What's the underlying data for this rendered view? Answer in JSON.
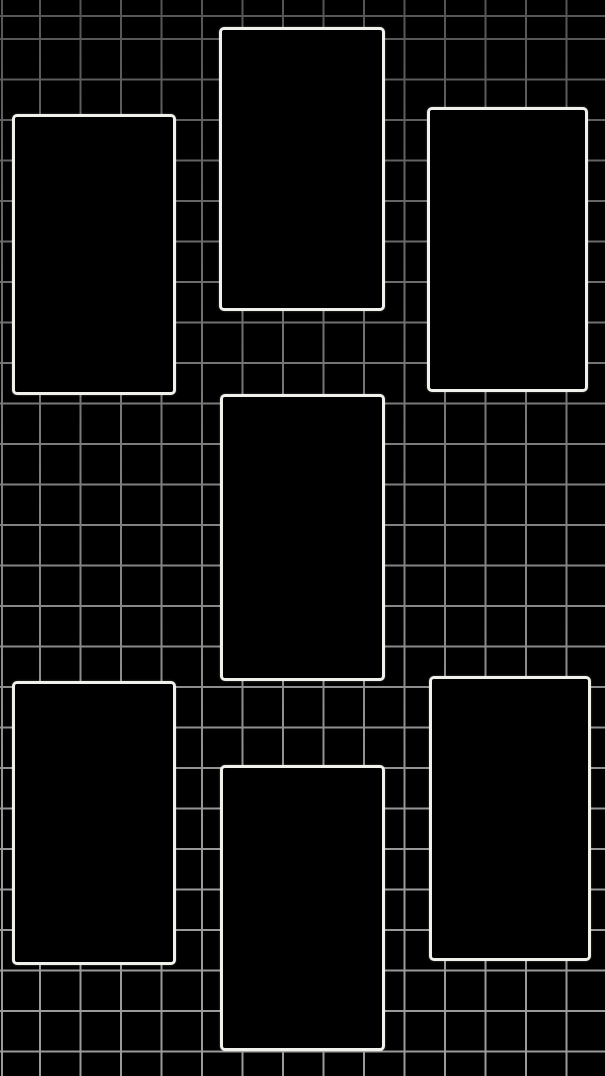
{
  "canvas": {
    "width_px": 605,
    "height_px": 1076,
    "background_color": "#000000",
    "grid": {
      "spacing_px": 40.5,
      "line_thickness_px": 1.8,
      "line_color": "#9a9a9a",
      "offset_x_px": 39,
      "offset_y_px": 38,
      "top_dim_opacity": 0.45
    },
    "frames": {
      "border_color": "#f0f1ea",
      "fill_color": "#000000",
      "border_width_px": 3,
      "corner_radius_px": 5,
      "items": [
        {
          "id": "frame-top-left",
          "x": 12,
          "y": 114,
          "w": 164,
          "h": 281
        },
        {
          "id": "frame-top-center",
          "x": 219,
          "y": 27,
          "w": 166,
          "h": 284
        },
        {
          "id": "frame-top-right",
          "x": 427,
          "y": 107,
          "w": 161,
          "h": 285
        },
        {
          "id": "frame-middle-center",
          "x": 220,
          "y": 394,
          "w": 165,
          "h": 287
        },
        {
          "id": "frame-bottom-left",
          "x": 12,
          "y": 681,
          "w": 164,
          "h": 284
        },
        {
          "id": "frame-bottom-center",
          "x": 220,
          "y": 765,
          "w": 165,
          "h": 286
        },
        {
          "id": "frame-bottom-right",
          "x": 429,
          "y": 676,
          "w": 162,
          "h": 285
        }
      ]
    }
  }
}
